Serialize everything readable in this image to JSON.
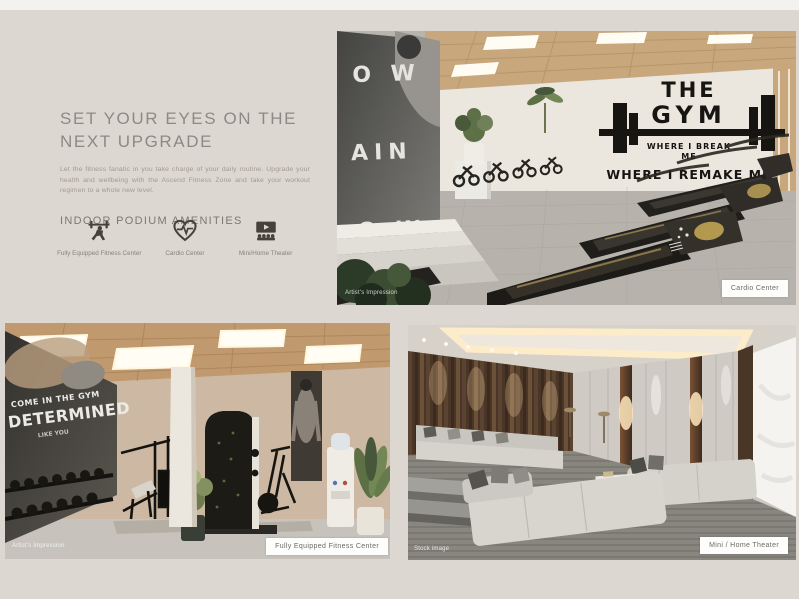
{
  "page": {
    "background_color": "#dcd8d1",
    "top_strip_color": "#f3f2ef"
  },
  "intro": {
    "heading_line1": "SET YOUR EYES ON THE",
    "heading_line2": "NEXT UPGRADE",
    "body_text": "Let the fitness fanatic in you take charge of your daily routine. Upgrade your health and wellbeing with the Ascend Fitness Zone and take your workout regimen to a whole new level.",
    "section_title": "INDOOR PODIUM AMENITIES"
  },
  "amenities": [
    {
      "icon": "barbell-lifter-icon",
      "label": "Fully Equipped Fitness Center"
    },
    {
      "icon": "heart-pulse-icon",
      "label": "Cardio Center"
    },
    {
      "icon": "home-theater-icon",
      "label": "Mini/Home Theater"
    }
  ],
  "gallery": {
    "cardio": {
      "label": "Cardio Center",
      "caption": "Artist's Impression",
      "wall_art_line1": "THE",
      "wall_art_line2": "GYM",
      "wall_art_line3": "WHERE I BREAK",
      "wall_art_line4": "ME",
      "wall_art_line5": "WHERE I REMAKE ME",
      "mural_word1": "O W",
      "mural_word2": "AIN",
      "mural_word3": "O W"
    },
    "fitness": {
      "label": "Fully Equipped Fitness Center",
      "caption": "Artist's Impression",
      "mural_line1": "COME IN THE GYM",
      "mural_line2": "DETERMINED",
      "mural_line3": "LIKE YOU"
    },
    "theater": {
      "label": "Mini / Home Theater",
      "caption": "Stock image"
    }
  }
}
